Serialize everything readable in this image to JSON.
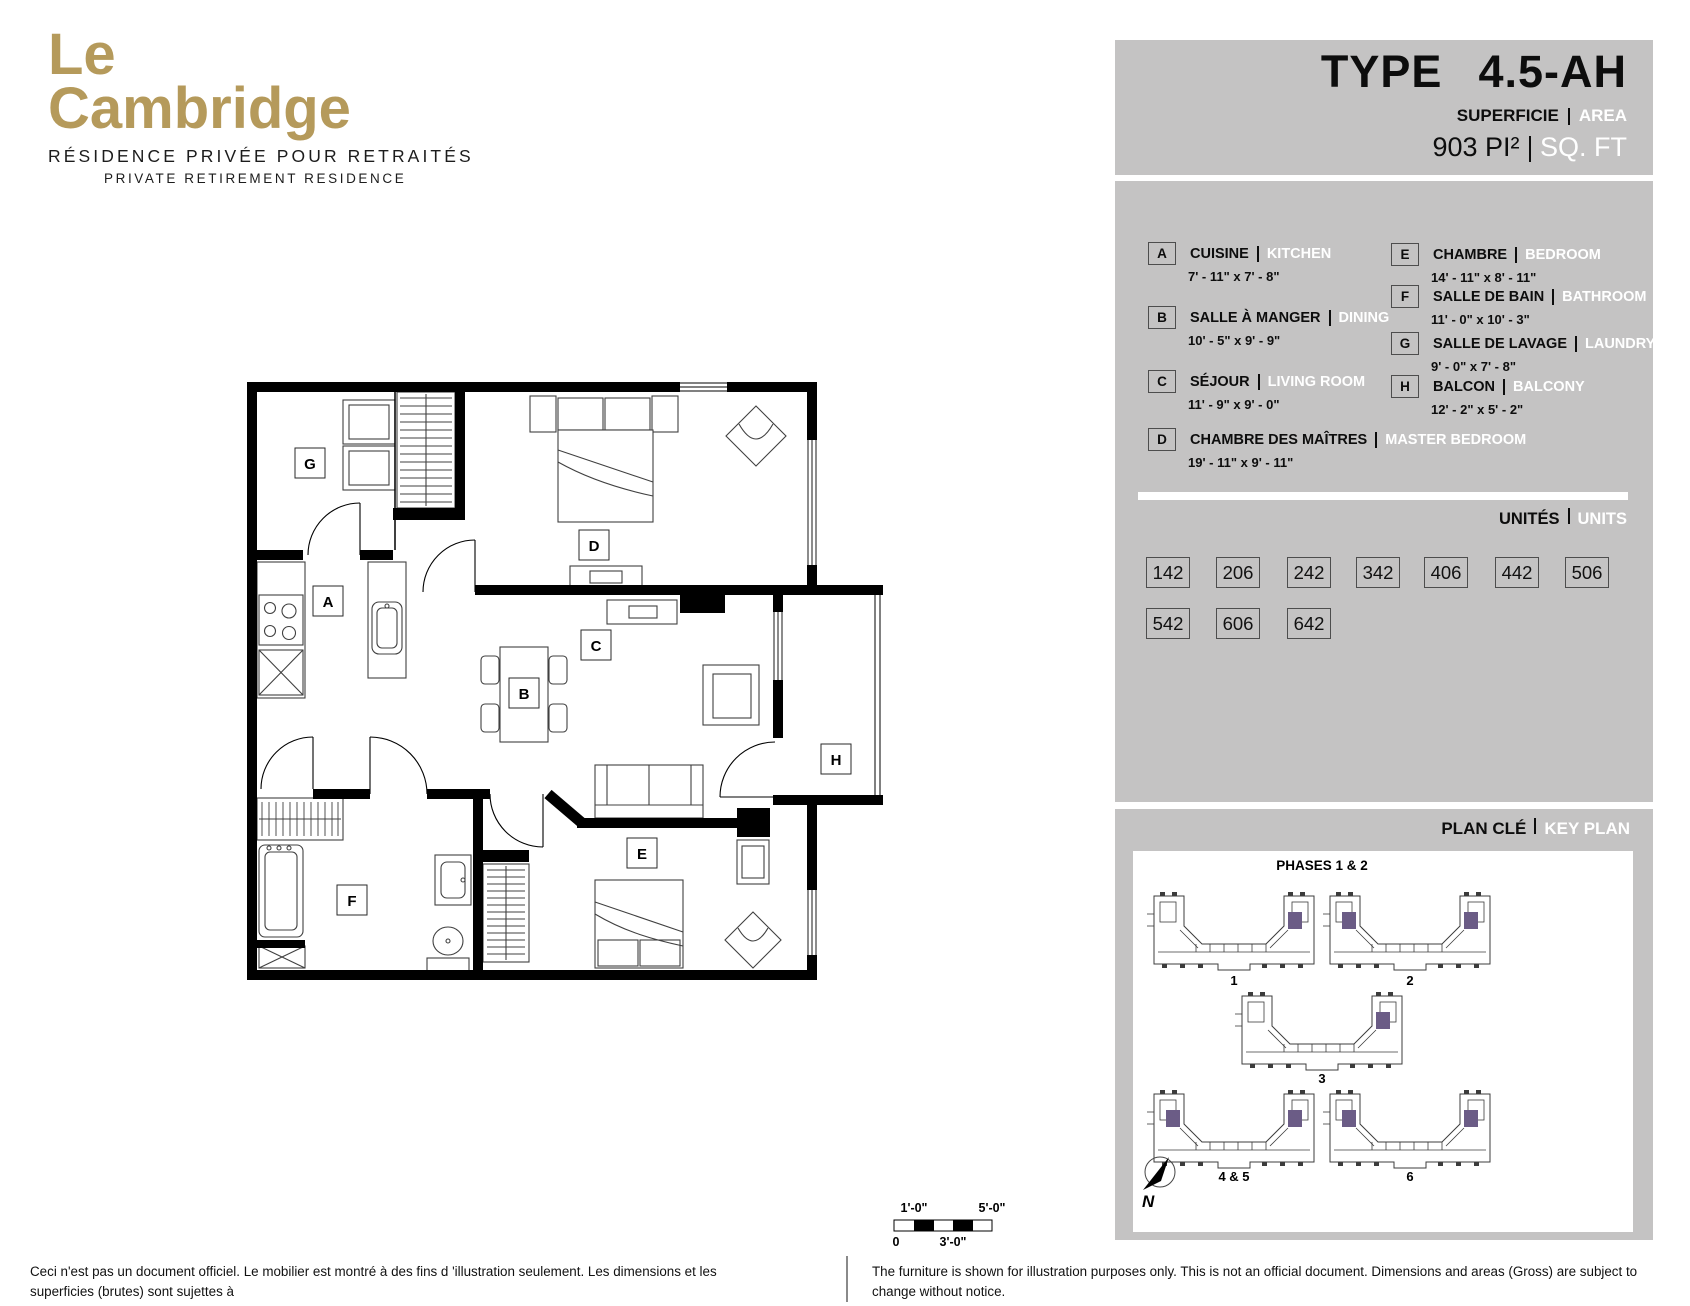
{
  "brand": {
    "name_line1": "Le",
    "name_line2": "Cambridge",
    "tagline_fr": "RÉSIDENCE PRIVÉE POUR RETRAITÉS",
    "tagline_en": "PRIVATE RETIREMENT RESIDENCE",
    "brand_color": "#b59a5b"
  },
  "header": {
    "type_label": "TYPE",
    "type_value": "4.5-AH",
    "superficie_label": "SUPERFICIE",
    "area_label": "AREA",
    "area_value_fr": "903 PI²",
    "area_value_en": "SQ. FT"
  },
  "legend": {
    "rooms": [
      {
        "letter": "A",
        "name_fr": "CUISINE",
        "name_en": "KITCHEN",
        "dimensions": "7' - 11\" x 7' - 8\""
      },
      {
        "letter": "B",
        "name_fr": "SALLE À MANGER",
        "name_en": "DINING",
        "dimensions": "10' - 5\" x 9' - 9\""
      },
      {
        "letter": "C",
        "name_fr": "SÉJOUR",
        "name_en": "LIVING ROOM",
        "dimensions": "11' - 9\" x 9' - 0\""
      },
      {
        "letter": "D",
        "name_fr": "CHAMBRE DES MAÎTRES",
        "name_en": "MASTER BEDROOM",
        "dimensions": "19' - 11\" x 9' - 11\""
      },
      {
        "letter": "E",
        "name_fr": "CHAMBRE",
        "name_en": "BEDROOM",
        "dimensions": "14' - 11\" x 8' - 11\""
      },
      {
        "letter": "F",
        "name_fr": "SALLE DE BAIN",
        "name_en": "BATHROOM",
        "dimensions": "11' - 0\" x 10' - 3\""
      },
      {
        "letter": "G",
        "name_fr": "SALLE DE LAVAGE",
        "name_en": "LAUNDRY ROOM",
        "dimensions": "9' - 0\" x 7' - 8\""
      },
      {
        "letter": "H",
        "name_fr": "BALCON",
        "name_en": "BALCONY",
        "dimensions": "12' - 2\" x 5' - 2\""
      }
    ]
  },
  "units": {
    "title_fr": "UNITÉS",
    "title_en": "UNITS",
    "numbers": [
      "142",
      "206",
      "242",
      "342",
      "406",
      "442",
      "506",
      "542",
      "606",
      "642"
    ]
  },
  "key_plan": {
    "title_fr": "PLAN CLÉ",
    "title_en": "KEY PLAN",
    "phases_label": "PHASES 1 & 2",
    "building_labels": [
      "1",
      "2",
      "3",
      "4 & 5",
      "6"
    ],
    "north_label": "N",
    "highlight_color": "#6b5c86"
  },
  "scale_bar": {
    "top_left_label": "1'-0\"",
    "top_right_label": "5'-0\"",
    "bottom_left_label": "0",
    "bottom_mid_label": "3'-0\""
  },
  "disclaimer": {
    "fr_line1": "Ceci n'est pas un document officiel.  Le mobilier est montré à des fins d 'illustration seulement.  Les dimensions et les superficies (brutes) sont sujettes à",
    "fr_line2": "changement sans préavis. La superficie et la position des éléments structuraux peuvent varier en fonction de l'emplacement de l'unité dans le bâtiment.",
    "en_line1": "The furniture is shown for illustration purposes only.  This is not an official document.  Dimensions and areas (Gross) are subject to change without notice.",
    "en_line2": "Area and position of structural elements may vary depending of location of unit in building."
  }
}
